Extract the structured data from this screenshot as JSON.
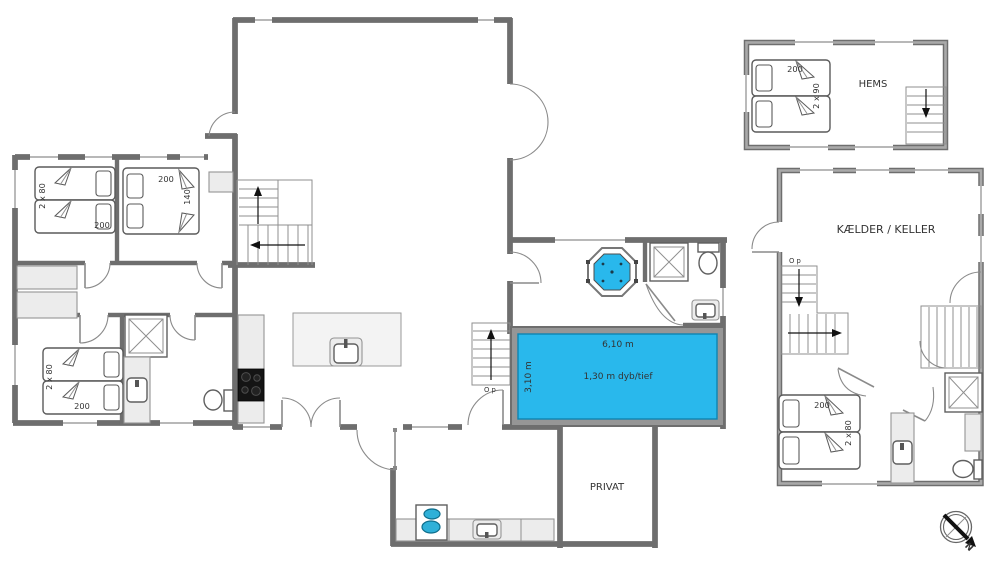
{
  "colors": {
    "pool": "#29b8ec",
    "wall": "#8a8a8a",
    "fixture": "#ececec"
  },
  "ground_floor": {
    "bedroom_nw": {
      "bed_width": "2 x 80",
      "bed_length": "200"
    },
    "bedroom_n": {
      "bed_length": "200",
      "bed_width": "140"
    },
    "bedroom_sw": {
      "bed_width": "2 x 80",
      "bed_length": "200"
    },
    "stairs_note": "O p",
    "pool": {
      "length": "6,10 m",
      "depth": "1,30 m dyb/tief",
      "width": "3,10 m"
    },
    "annex": {
      "room_label": "PRIVAT"
    }
  },
  "loft": {
    "room_label": "HEMS",
    "bed_length": "200",
    "bed_width": "2 x 90"
  },
  "basement": {
    "room_label": "KÆLDER / KELLER",
    "stairs_note": "O p",
    "bedroom": {
      "bed_length": "200",
      "bed_width": "2 x 80"
    }
  },
  "compass": {
    "north_label": "N"
  }
}
